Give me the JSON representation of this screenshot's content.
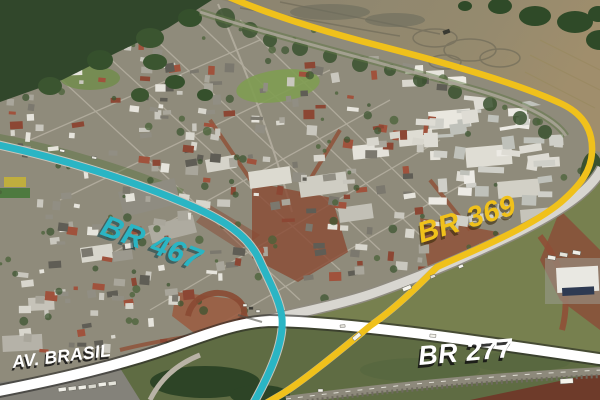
{
  "annotations": {
    "br467": {
      "label": "BR 467",
      "color": "#2ab5c4"
    },
    "br369": {
      "label": "BR 369",
      "color": "#f0c11b"
    },
    "br277": {
      "label": "BR 277",
      "color": "#ffffff"
    },
    "av_brasil": {
      "label": "AV. BRASIL",
      "color": "#ffffff"
    }
  }
}
